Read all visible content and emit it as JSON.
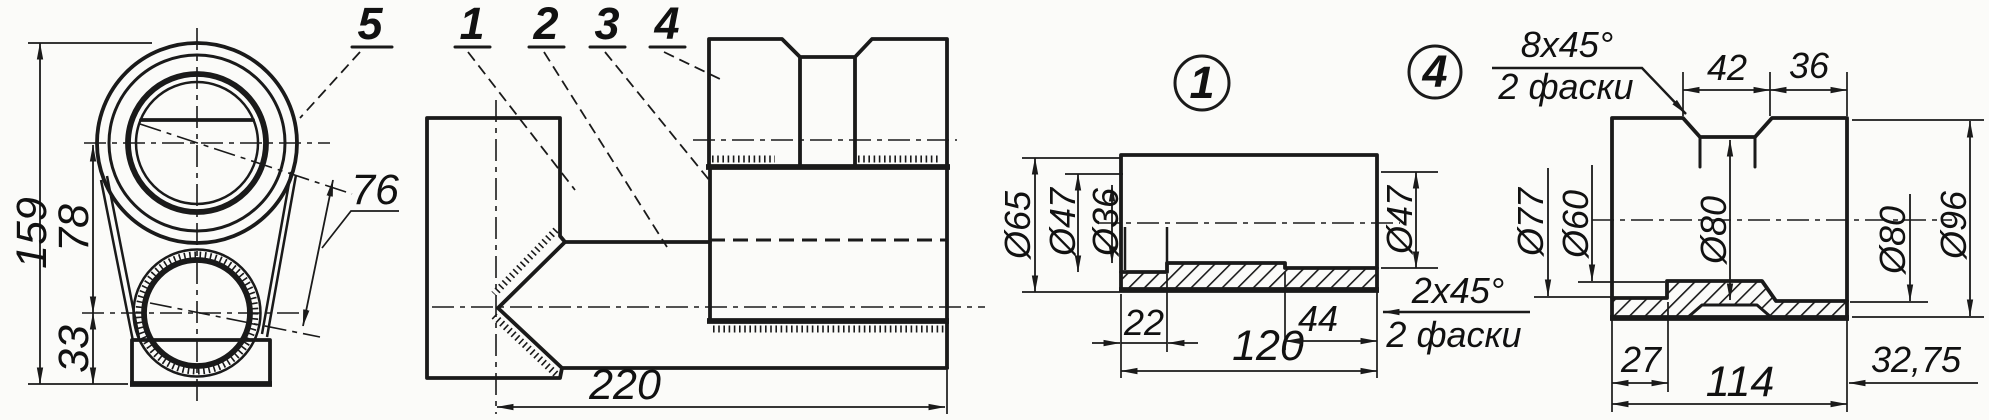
{
  "callouts": {
    "c1": "1",
    "c2": "2",
    "c3": "3",
    "c4": "4",
    "c5": "5"
  },
  "front_view": {
    "dim_height_total": "159",
    "dim_center_distance": "78",
    "dim_base_height": "33",
    "dim_axis_distance": "76"
  },
  "side_view": {
    "dim_length": "220"
  },
  "part1": {
    "balloon": "1",
    "dim_d_outer": "Ø65",
    "dim_d_bore_left": "Ø47",
    "dim_d_bore_mid": "Ø36",
    "dim_d_bore_right": "Ø47",
    "dim_len_left": "22",
    "dim_len_total": "120",
    "dim_len_right": "44",
    "chamfer_spec": "2x45°",
    "chamfer_note": "2 фаски"
  },
  "part4": {
    "balloon": "4",
    "chamfer_spec": "8x45°",
    "chamfer_note": "2 фаски",
    "dim_groove_width": "42",
    "dim_right_width": "36",
    "dim_d_recess_left": "Ø77",
    "dim_d_bore": "Ø60",
    "dim_d_groove": "Ø80",
    "dim_d_recess_right": "Ø80",
    "dim_d_outer": "Ø96",
    "dim_len_left": "27",
    "dim_len_total": "114",
    "dim_len_right": "32,75"
  }
}
